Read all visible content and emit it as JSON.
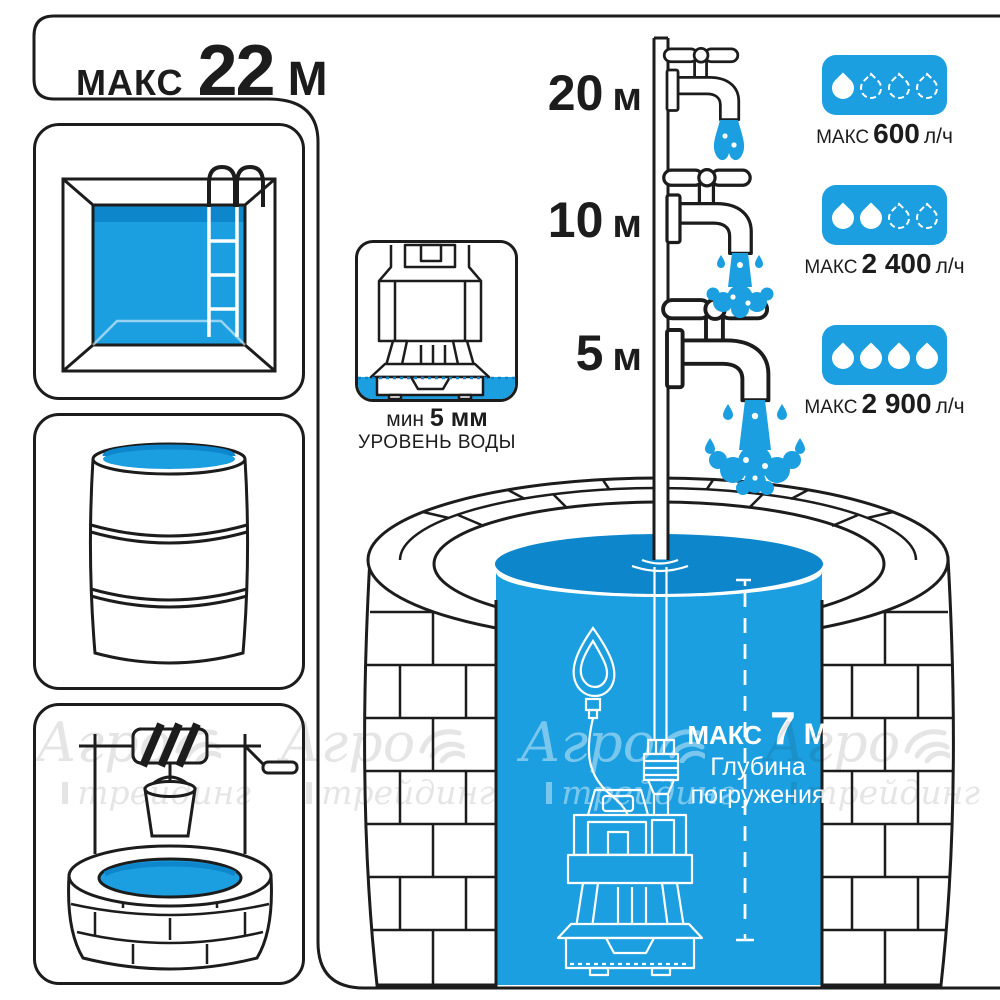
{
  "title": {
    "prefix": "МАКС",
    "value": "22",
    "unit": "М"
  },
  "sidebar_icons": [
    "pool-icon",
    "barrel-icon",
    "well-with-bucket-icon"
  ],
  "min_level": {
    "prefix": "мин",
    "value": "5 мм",
    "caption": "УРОВЕНЬ ВОДЫ"
  },
  "risers": [
    {
      "value": "20",
      "unit": "м"
    },
    {
      "value": "10",
      "unit": "м"
    },
    {
      "value": "5",
      "unit": "м"
    }
  ],
  "flow_badges": [
    {
      "prefix": "МАКС",
      "value": "600",
      "unit": "л/ч",
      "drops_filled": 1,
      "drops_dashed": 3
    },
    {
      "prefix": "МАКС",
      "value": "2 400",
      "unit": "л/ч",
      "drops_filled": 2,
      "drops_dashed": 2
    },
    {
      "prefix": "МАКС",
      "value": "2 900",
      "unit": "л/ч",
      "drops_filled": 4,
      "drops_dashed": 0
    }
  ],
  "immersion": {
    "prefix": "МАКС",
    "value": "7",
    "unit": "М",
    "caption_line1": "Глубина",
    "caption_line2": "погружения"
  },
  "watermark": {
    "word1": "Агро",
    "word2": "трейдинг"
  },
  "colors": {
    "water_blue": "#1b9fe0",
    "water_dark": "#0d86cc",
    "outline": "#1c1c1c"
  }
}
